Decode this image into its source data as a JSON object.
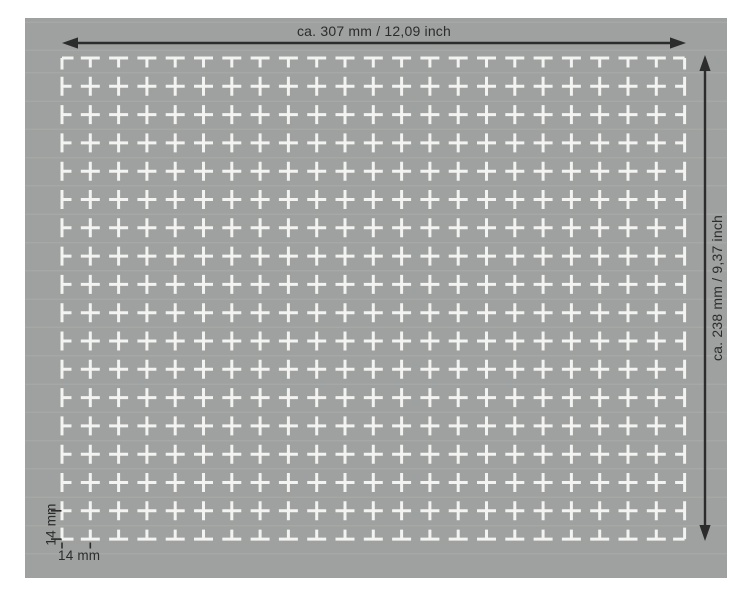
{
  "diagram": {
    "dimensions": {
      "width_label": "ca. 307 mm / 12,09 inch",
      "height_label": "ca. 238 mm / 9,37 inch",
      "row_pitch_label": "14 mm",
      "column_pitch_label": "14 mm"
    },
    "grid": {
      "rows": 18,
      "columns": 23,
      "pitch_mm": 14
    },
    "colors": {
      "background": "#ffffff",
      "panel": "#9ea19f",
      "marks": "#f3f3f1",
      "annotation": "#2c2c2c"
    }
  }
}
